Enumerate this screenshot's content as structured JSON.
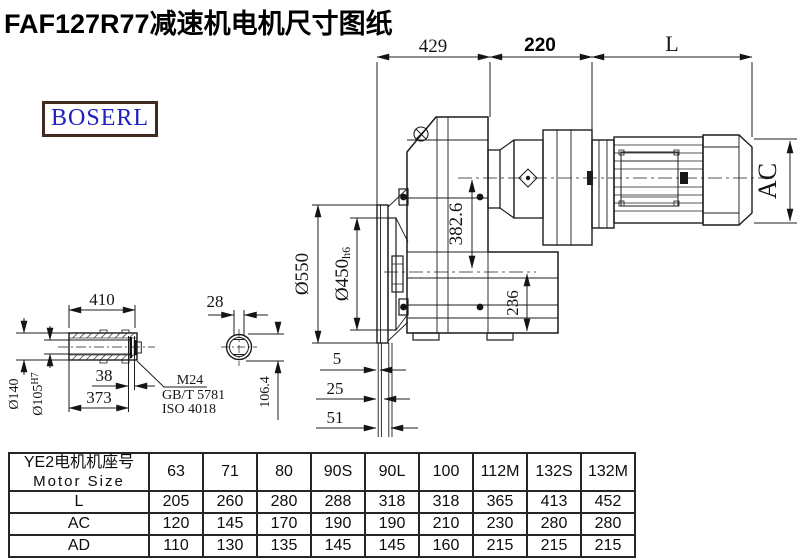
{
  "header": {
    "title": "FAF127R77减速机电机尺寸图纸",
    "logo": "BOSERL"
  },
  "colors": {
    "line": "#1c1c1c",
    "logo_text": "#2020c0",
    "logo_border": "#40291f",
    "background": "#ffffff"
  },
  "drawing": {
    "dims_top": {
      "gear_length": "429",
      "adapter_length": "220",
      "motor_length": "L"
    },
    "dims_main": {
      "motor_diameter": "AC",
      "axis_distance": "382.6",
      "below_axis": "236",
      "flange_od": "Ø550",
      "flange_pilot": "Ø450",
      "flange_pilot_tol": "h6",
      "offset_1": "5",
      "offset_2": "25",
      "offset_3": "51"
    },
    "detail": {
      "shaft_length": "410",
      "end_gap": "38",
      "shaft_inner_length": "373",
      "hub_od": "Ø140",
      "bore": "Ø105",
      "bore_tol": "H7",
      "section_width": "28",
      "section_height": "106.4",
      "bolt_spec": "M24",
      "bolt_std_gb": "GB/T 5781",
      "bolt_std_iso": "ISO 4018"
    }
  },
  "table": {
    "header_cn": "YE2电机机座号",
    "header_en": "Motor Size",
    "columns": [
      "63",
      "71",
      "80",
      "90S",
      "90L",
      "100",
      "112M",
      "132S",
      "132M"
    ],
    "rows": [
      {
        "label": "L",
        "values": [
          "205",
          "260",
          "280",
          "288",
          "318",
          "318",
          "365",
          "413",
          "452"
        ]
      },
      {
        "label": "AC",
        "values": [
          "120",
          "145",
          "170",
          "190",
          "190",
          "210",
          "230",
          "280",
          "280"
        ]
      },
      {
        "label": "AD",
        "values": [
          "110",
          "130",
          "135",
          "145",
          "145",
          "160",
          "215",
          "215",
          "215"
        ]
      }
    ]
  }
}
